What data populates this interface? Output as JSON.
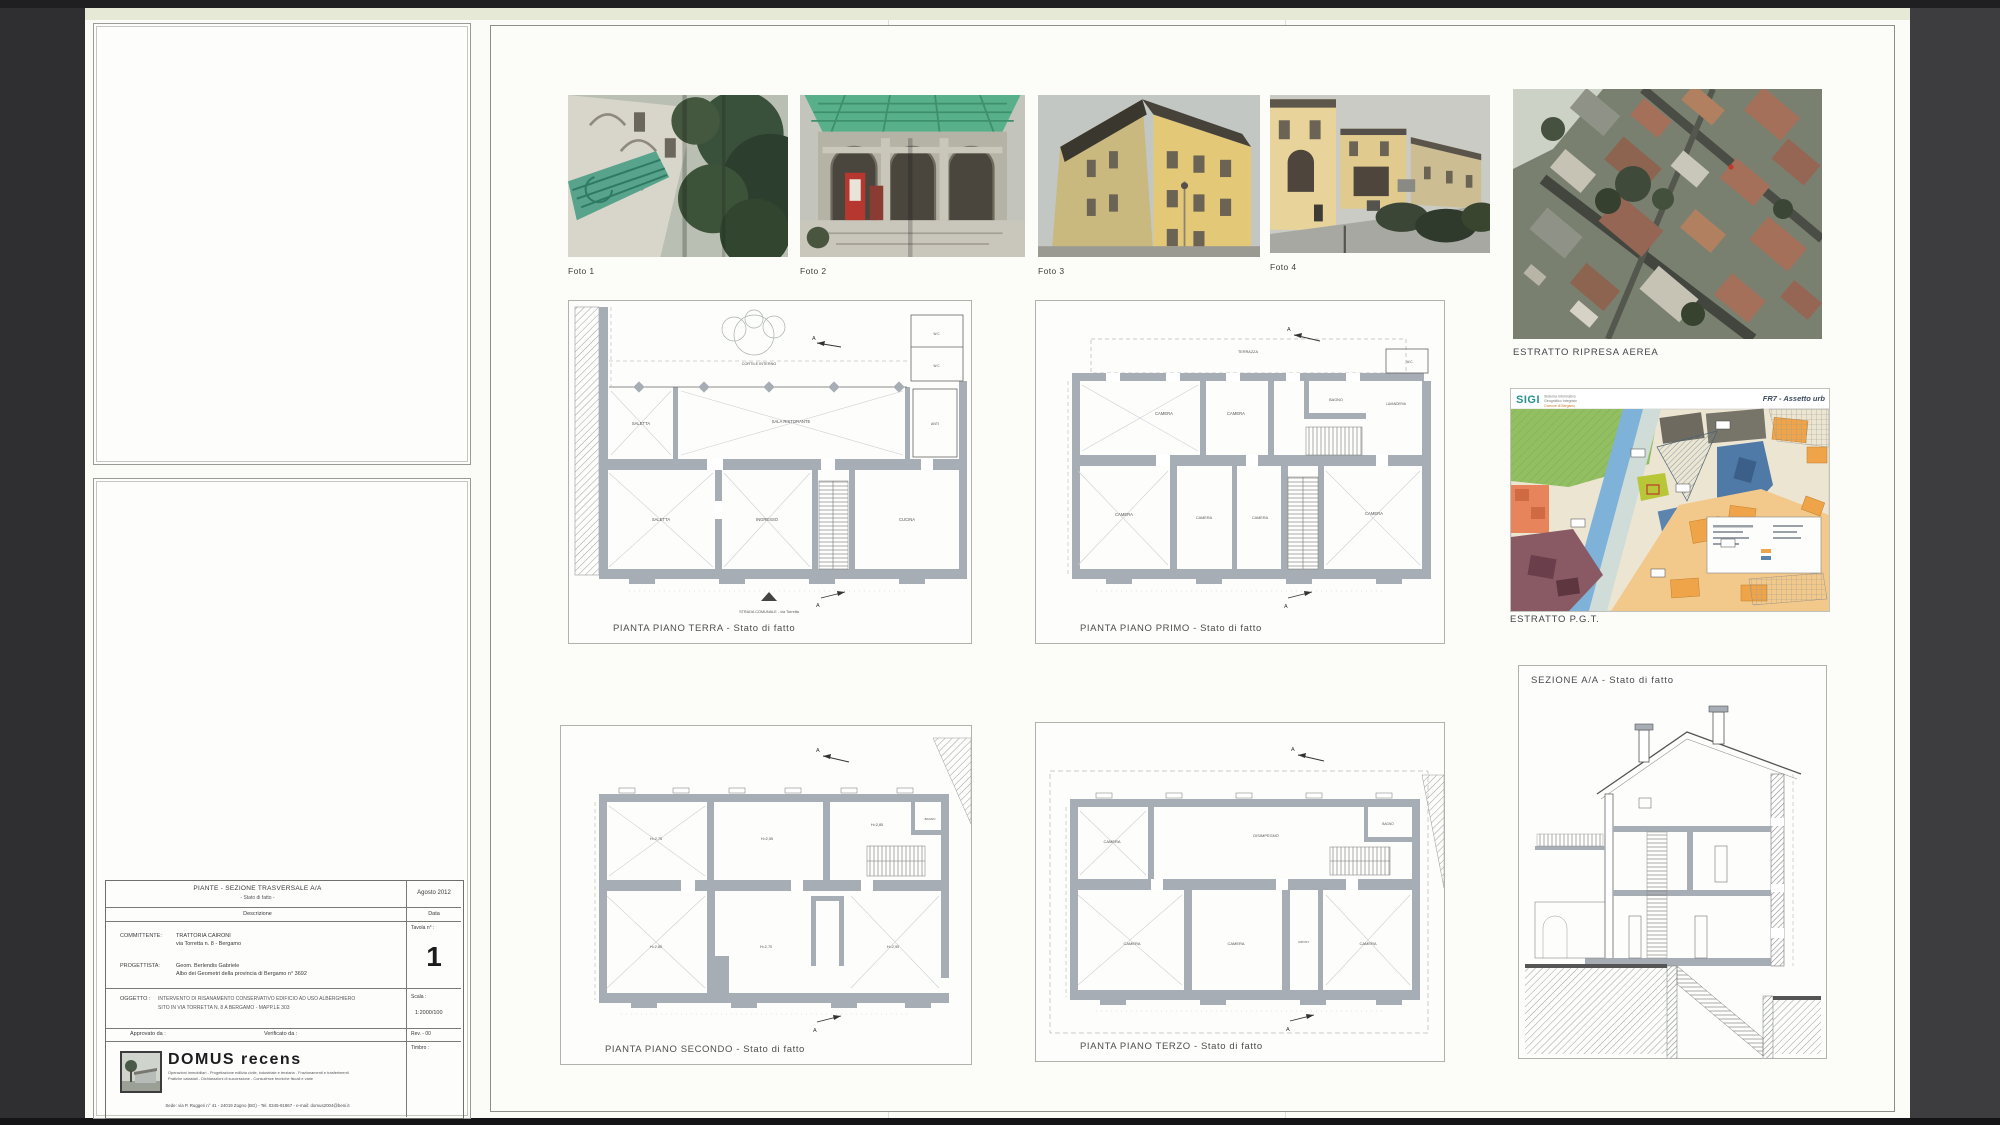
{
  "photos": {
    "items": [
      {
        "label": "Foto 1"
      },
      {
        "label": "Foto 2"
      },
      {
        "label": "Foto 3"
      },
      {
        "label": "Foto 4"
      }
    ]
  },
  "aerial": {
    "caption": "ESTRATTO RIPRESA AEREA"
  },
  "pgt": {
    "logo": "SIGI",
    "logo_line1": "Sistema Informativo",
    "logo_line2": "Geografico Integrato",
    "logo_sub": "Comune di Bergamo",
    "sheet_ref": "FR7 - Assetto urb",
    "caption": "ESTRATTO P.G.T."
  },
  "plans": {
    "terra": {
      "caption": "PIANTA PIANO TERRA - Stato di fatto",
      "labels": {
        "cortile": "CORTILE INTERNO",
        "saletta_a": "SALETTA",
        "sala": "SALA RISTORANTE",
        "wc1": "W.C.",
        "wc2": "W.C.",
        "anti": "ANTI",
        "saletta_b": "SALETTA",
        "ingresso": "INGRESSO",
        "cucina": "CUCINA",
        "strada": "STRADA COMUNALE - via Torretta",
        "sec_a": "A"
      }
    },
    "primo": {
      "caption": "PIANTA PIANO PRIMO - Stato di fatto",
      "labels": {
        "terrazza": "TERRAZZA",
        "camera1": "CAMERA",
        "camera2": "CAMERA",
        "camera3": "CAMERA",
        "camera4": "CAMERA",
        "camera5": "CAMERA",
        "camera6": "CAMERA",
        "bagno": "BAGNO",
        "lavanderia": "LAVANDERIA",
        "wc": "W.C.",
        "sec_a": "A"
      }
    },
    "secondo": {
      "caption": "PIANTA PIANO SECONDO - Stato di fatto",
      "labels": {
        "r1": "H=2,75",
        "r2": "H=2,55",
        "r3": "H=2,85",
        "bagno": "BAGNO",
        "r4": "H=2,80",
        "r5": "H=2,70",
        "r6": "H=2,90",
        "sec_a": "A"
      }
    },
    "terzo": {
      "caption": "PIANTA PIANO TERZO - Stato di fatto",
      "labels": {
        "camera1": "CAMERA",
        "disimpegno": "DISIMPEGNO",
        "bagno": "BAGNO",
        "camera2": "CAMERA",
        "camera3": "CAMERA",
        "ripostiglio": "RIPOST.",
        "camera4": "CAMERA",
        "sec_a": "A"
      }
    }
  },
  "section_drawing": {
    "title": "SEZIONE A/A - Stato di fatto"
  },
  "titleblock": {
    "title": "PIANTE - SEZIONE TRASVERSALE A/A",
    "subtitle": "- Stato di fatto -",
    "date_value": "Agosto 2012",
    "descr_label": "Descrizione",
    "date_label": "Data",
    "committente_label": "COMMITTENTE:",
    "committente_line1": "TRATTORIA CAIRONI",
    "committente_line2": "via Torretta n. 8 - Bergamo",
    "tavola_label": "Tavola n° :",
    "tavola_value": "1",
    "progettista_label": "PROGETTISTA:",
    "progettista_line1": "Geom. Berlendis Gabriele",
    "progettista_line2": "Albo dei Geometri della provincia di Bergamo n° 3692",
    "oggetto_label": "OGGETTO :",
    "oggetto_line1": "INTERVENTO DI RISANAMENTO CONSERVATIVO EDIFICIO AD USO ALBERGHIERO",
    "oggetto_line2": "SITO IN VIA TORRETTA N. 8 A BERGAMO - MAPP.LE 303",
    "scala_label": "Scala :",
    "scala_value": "1:2000/100",
    "approvato_label": "Approvato da :",
    "verificato_label": "Verificato da :",
    "rev_value": "Rev. - 00",
    "timbro_label": "Timbro :",
    "logo_name": "DOMUS recens",
    "logo_tagline1": "Operazioni immobiliari - Progettazione edilizia civile, industriale e terziaria - Frazionamenti e trasferimenti",
    "logo_tagline2": "Pratiche catastali - Dichiarazioni di successione - Consulenze tecniche fiscali e varie",
    "footer": "Sede: via P. Ruggeri n° 41 - 24019 Zogno (BG) - Tel. 0345-91867 - e-mail: domus2004@beni.it"
  }
}
